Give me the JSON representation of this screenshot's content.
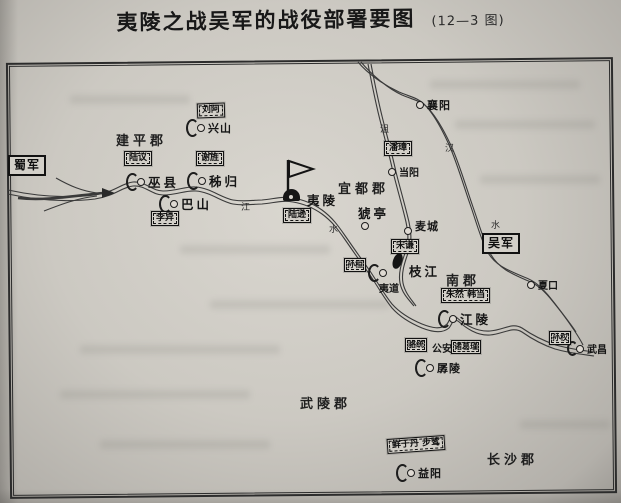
{
  "page": {
    "title": "夷陵之战吴军的战役部署要图",
    "figure_no": "(12—3 图)"
  },
  "map": {
    "armies": [
      {
        "label": "蜀军"
      },
      {
        "label": "吴军"
      }
    ],
    "units": [
      {
        "label": "刘阿"
      },
      {
        "label": "陆议"
      },
      {
        "label": "谢旌"
      },
      {
        "label": "李异"
      },
      {
        "label": "陆逊"
      },
      {
        "label": "潘璋"
      },
      {
        "label": "宋谦"
      },
      {
        "label": "孙桓"
      },
      {
        "label": "朱然 韩当"
      },
      {
        "label": "骆统"
      },
      {
        "label": "诸葛瑾"
      },
      {
        "label": "鲜于丹 步骘"
      },
      {
        "label": "孙权"
      }
    ],
    "places": [
      {
        "label": "襄阳"
      },
      {
        "label": "兴山"
      },
      {
        "label": "巫县"
      },
      {
        "label": "秭归"
      },
      {
        "label": "巴山"
      },
      {
        "label": "当阳"
      },
      {
        "label": "夷陵"
      },
      {
        "label": "猇亭"
      },
      {
        "label": "麦城"
      },
      {
        "label": "枝江"
      },
      {
        "label": "夷道"
      },
      {
        "label": "江陵"
      },
      {
        "label": "公安"
      },
      {
        "label": "孱陵"
      },
      {
        "label": "益阳"
      },
      {
        "label": "夏口"
      },
      {
        "label": "武昌"
      }
    ],
    "regions": [
      {
        "label": "建平郡"
      },
      {
        "label": "宜都郡"
      },
      {
        "label": "南郡"
      },
      {
        "label": "武陵郡"
      },
      {
        "label": "长沙郡"
      }
    ],
    "river_labels": [
      {
        "label": "江"
      },
      {
        "label": "水"
      },
      {
        "label": "沮"
      },
      {
        "label": "汉"
      },
      {
        "label": "水"
      }
    ]
  }
}
